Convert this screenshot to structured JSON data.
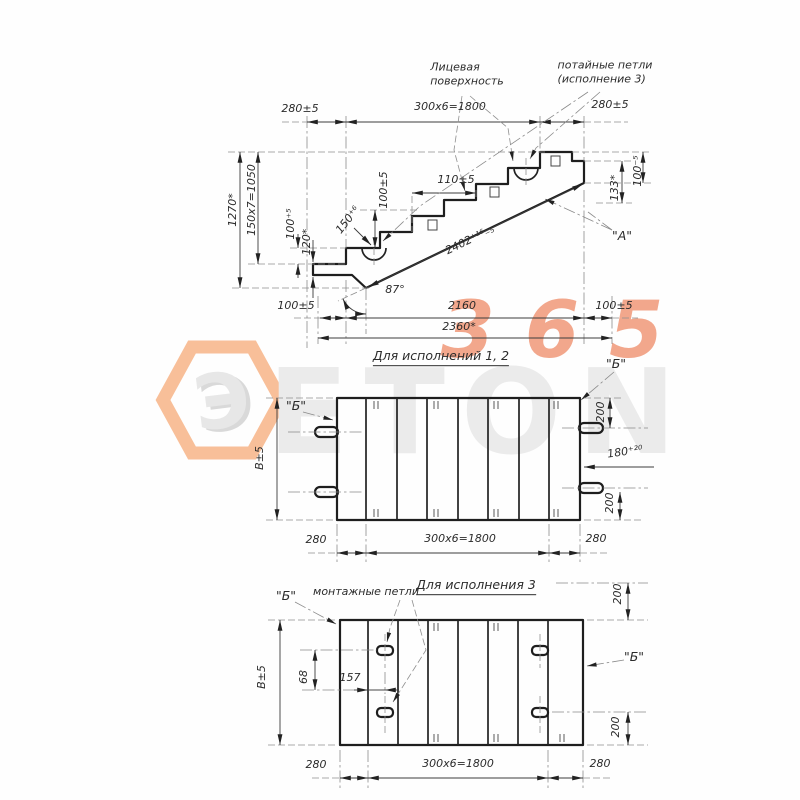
{
  "watermark": {
    "brand": "ETON",
    "number": "365",
    "logo_letter": "Э",
    "orange": "#f6b183",
    "gray": "#ebebeb"
  },
  "side_view": {
    "face_surface_label": "Лицевая\nповерхность",
    "hidden_loops_label": "потайные петли\n(исполнение 3)",
    "surface_mark": "\"А\"",
    "dims": {
      "top_left": "280±5",
      "top_middle": "300x6=1800",
      "top_right": "280±5",
      "overall_height": "1270*",
      "riser_height": "150x7=1050",
      "height_100": "100⁺⁵",
      "height_120": "120*",
      "riser_100": "100±5",
      "tread_110": "110±5",
      "nose_150": "150⁺⁶",
      "slope_length": "2402⁺¹⁶₋₅",
      "angle_87": "87°",
      "bottom_left_100": "100±5",
      "bottom_2160": "2160",
      "bottom_2360": "2360*",
      "bottom_right_100": "100±5",
      "end_133": "133*",
      "end_100": "100⁻⁵"
    }
  },
  "plan_view_12": {
    "title": "Для исполнений 1, 2",
    "section_left": "\"Б\"",
    "section_right": "\"Б\"",
    "dims": {
      "top_200": "200",
      "depth_180": "180⁺²⁰",
      "bottom_200": "200",
      "width_b": "В±5",
      "bottom_left_280": "280",
      "bottom_middle": "300x6=1800",
      "bottom_right_280": "280"
    }
  },
  "plan_view_3": {
    "title": "Для исполнения 3",
    "loops_label": "монтажные петли",
    "section_left": "\"Б\"",
    "section_right": "\"Б\"",
    "dims": {
      "top_200": "200",
      "bottom_200": "200",
      "loop_68": "68",
      "loop_157": "157",
      "width_b": "В±5",
      "bottom_left_280": "280",
      "bottom_middle": "300x6=1800",
      "bottom_right_280": "280"
    }
  }
}
